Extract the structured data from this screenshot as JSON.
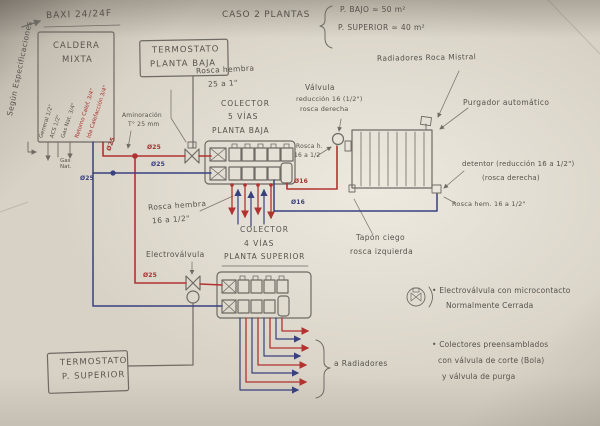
{
  "header": {
    "boiler_ref": "BAXI 24/24F",
    "caso_title": "CASO 2 PLANTAS",
    "caso_items": [
      "P. BAJO ≈ 50 m²",
      "P. SUPERIOR ≈ 40 m²"
    ],
    "side_note": "Según Especificaciones"
  },
  "caldera": {
    "name_line1": "CALDERA",
    "name_line2": "MIXTA",
    "connections": [
      "General 1/2\"",
      "ACS 1/2\"",
      "Gas Nat. 3/4\"",
      "Retorno Calef. 3/4\"",
      "Ida Calefacción 3/4\""
    ],
    "gas_label": "Gas Nat."
  },
  "termostatos": {
    "pb_line1": "TERMOSTATO",
    "pb_line2": "PLANTA BAJA",
    "ps_line1": "TERMOSTATO",
    "ps_line2": "P. SUPERIOR"
  },
  "colectores": {
    "pb_line1": "COLECTOR",
    "pb_line2": "5 VÍAS",
    "pb_line3": "PLANTA BAJA",
    "ps_line1": "COLECTOR",
    "ps_line2": "4 VÍAS",
    "ps_line3": "PLANTA SUPERIOR"
  },
  "annotations": {
    "rosca_hembra_25_l1": "Rosca hembra",
    "rosca_hembra_25_l2": "25 a 1\"",
    "aminoracion_l1": "Aminoración",
    "aminoracion_l2": "T° 25 mm",
    "valvula_l1": "Válvula",
    "valvula_l2": "reducción 16 (1/2\")",
    "valvula_l3": "rosca derecha",
    "rosca_h_rad_l1": "Rosca h.",
    "rosca_h_rad_l2": "16 a 1/2",
    "radiadores_marca": "Radiadores Roca Mistral",
    "purgador": "Purgador automático",
    "detentor_l1": "detentor (reducción 16 a 1/2\")",
    "detentor_l2": "(rosca derecha)",
    "rosca_hem_16": "Rosca hem. 16 a 1/2\"",
    "tapon_l1": "Tapón ciego",
    "tapon_l2": "rosca izquierda",
    "rosca_hembra_16_l1": "Rosca hembra",
    "rosca_hembra_16_l2": "16 a 1/2\"",
    "electrovalvula": "Electroválvula",
    "a_radiadores": "a Radiadores"
  },
  "notas": {
    "n1_l1": "• Electroválvula con microcontacto",
    "n1_l2": "Normalmente Cerrada",
    "n2_l1": "• Colectores preensamblados",
    "n2_l2": "con válvula de corte (Bola)",
    "n2_l3": "y válvula de purga"
  },
  "pipe_labels": {
    "d25": "Ø25",
    "d16": "Ø16"
  },
  "colors": {
    "pencil": "#6e6a64",
    "red": "#b23230",
    "blue": "#39407e",
    "paper": "#d8d2c6"
  }
}
